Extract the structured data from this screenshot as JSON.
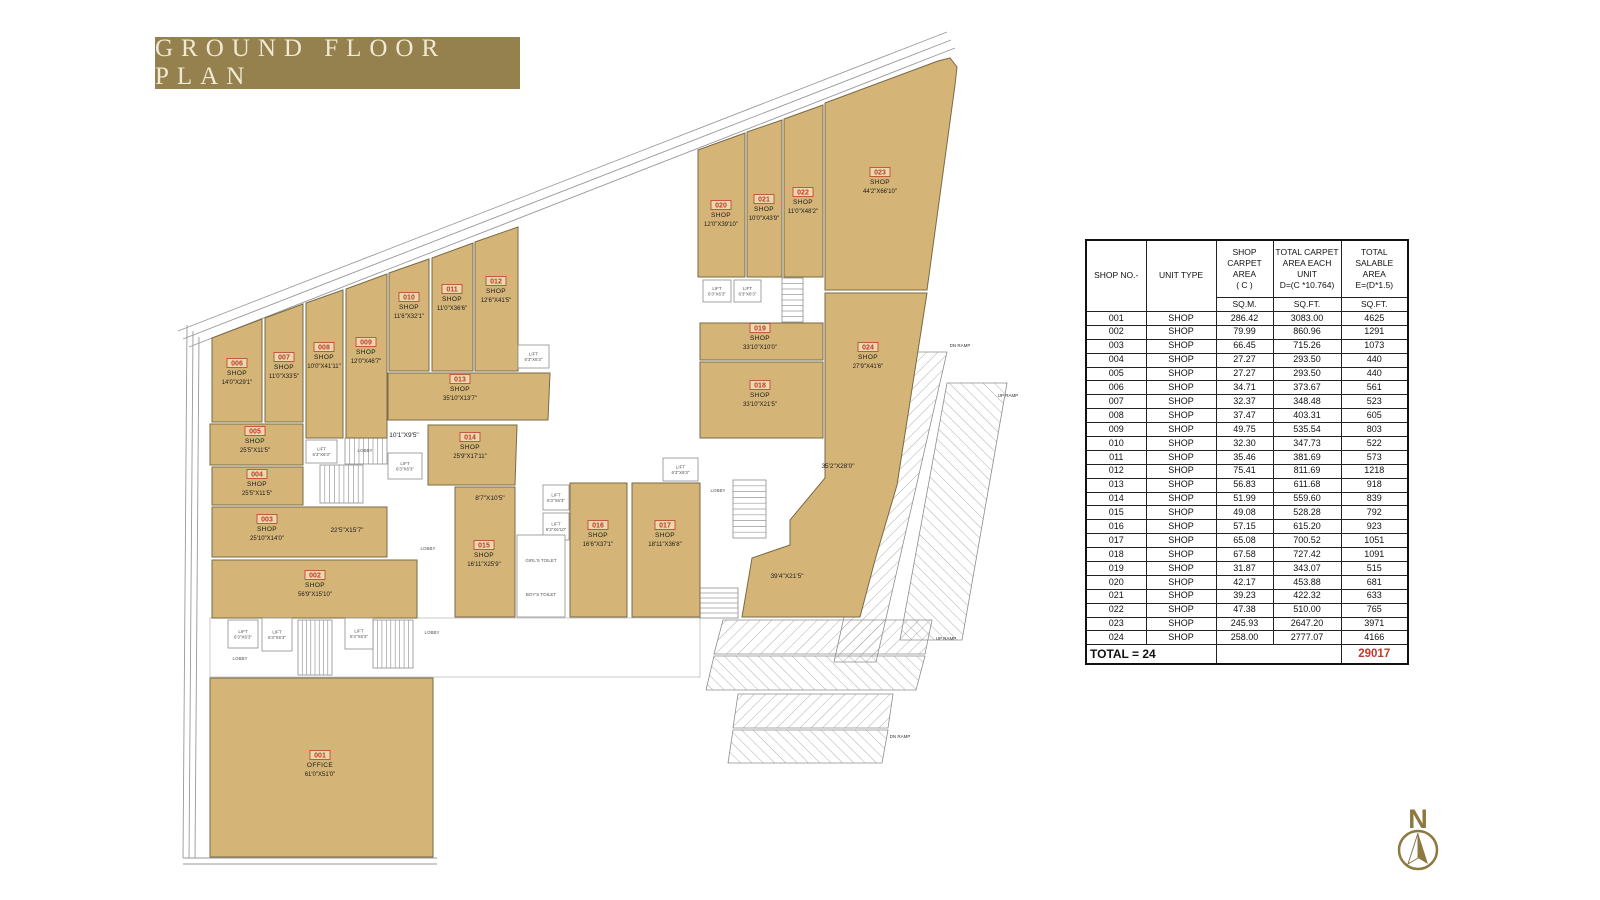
{
  "title": "GROUND FLOOR PLAN",
  "colors": {
    "banner_bg": "#94814e",
    "banner_text": "#f2e9d4",
    "shop_fill": "#d4b577",
    "shop_stroke": "#7a6a45",
    "unit_number_red": "#bf3c28",
    "total_red": "#c0392b",
    "north_gold": "#8d7840",
    "line_gray": "#999999"
  },
  "table": {
    "headers": [
      {
        "lines": [
          "SHOP NO.-"
        ],
        "sub": null
      },
      {
        "lines": [
          "UNIT TYPE"
        ],
        "sub": null
      },
      {
        "lines": [
          "SHOP",
          "CARPET",
          "AREA",
          "( C )"
        ],
        "sub": "SQ.M."
      },
      {
        "lines": [
          "TOTAL CARPET",
          "AREA EACH UNIT",
          "D=(C *10.764)"
        ],
        "sub": "SQ.FT."
      },
      {
        "lines": [
          "TOTAL SALABLE",
          "AREA",
          "E=(D*1.5)"
        ],
        "sub": "SQ.FT."
      }
    ],
    "rows": [
      [
        "001",
        "SHOP",
        "286.42",
        "3083.00",
        "4625"
      ],
      [
        "002",
        "SHOP",
        "79.99",
        "860.96",
        "1291"
      ],
      [
        "003",
        "SHOP",
        "66.45",
        "715.26",
        "1073"
      ],
      [
        "004",
        "SHOP",
        "27.27",
        "293.50",
        "440"
      ],
      [
        "005",
        "SHOP",
        "27.27",
        "293.50",
        "440"
      ],
      [
        "006",
        "SHOP",
        "34.71",
        "373.67",
        "561"
      ],
      [
        "007",
        "SHOP",
        "32.37",
        "348.48",
        "523"
      ],
      [
        "008",
        "SHOP",
        "37.47",
        "403.31",
        "605"
      ],
      [
        "009",
        "SHOP",
        "49.75",
        "535.54",
        "803"
      ],
      [
        "010",
        "SHOP",
        "32.30",
        "347.73",
        "522"
      ],
      [
        "011",
        "SHOP",
        "35.46",
        "381.69",
        "573"
      ],
      [
        "012",
        "SHOP",
        "75.41",
        "811.69",
        "1218"
      ],
      [
        "013",
        "SHOP",
        "56.83",
        "611.68",
        "918"
      ],
      [
        "014",
        "SHOP",
        "51.99",
        "559.60",
        "839"
      ],
      [
        "015",
        "SHOP",
        "49.08",
        "528.28",
        "792"
      ],
      [
        "016",
        "SHOP",
        "57.15",
        "615.20",
        "923"
      ],
      [
        "017",
        "SHOP",
        "65.08",
        "700.52",
        "1051"
      ],
      [
        "018",
        "SHOP",
        "67.58",
        "727.42",
        "1091"
      ],
      [
        "019",
        "SHOP",
        "31.87",
        "343.07",
        "515"
      ],
      [
        "020",
        "SHOP",
        "42.17",
        "453.88",
        "681"
      ],
      [
        "021",
        "SHOP",
        "39.23",
        "422.32",
        "633"
      ],
      [
        "022",
        "SHOP",
        "47.38",
        "510.00",
        "765"
      ],
      [
        "023",
        "SHOP",
        "245.93",
        "2647.20",
        "3971"
      ],
      [
        "024",
        "SHOP",
        "258.00",
        "2777.07",
        "4166"
      ]
    ],
    "total_label": "TOTAL = 24",
    "total_value": "29017"
  },
  "plan": {
    "shops": [
      {
        "no": "001",
        "type": "OFFICE",
        "dim": "61'0\"X51'0\"",
        "poly": [
          [
            210,
            678
          ],
          [
            433,
            678
          ],
          [
            433,
            857
          ],
          [
            210,
            857
          ]
        ],
        "lx": 320,
        "ly": 758
      },
      {
        "no": "002",
        "type": "SHOP",
        "dim": "56'9\"X15'10\"",
        "poly": [
          [
            212,
            560
          ],
          [
            417,
            560
          ],
          [
            417,
            618
          ],
          [
            212,
            618
          ]
        ],
        "lx": 315,
        "ly": 578
      },
      {
        "no": "003",
        "type": "SHOP",
        "dim": "25'10\"X14'0\"",
        "poly": [
          [
            212,
            507
          ],
          [
            387,
            507
          ],
          [
            387,
            557
          ],
          [
            212,
            557
          ]
        ],
        "lx": 267,
        "ly": 522
      },
      {
        "no": "004",
        "type": "SHOP",
        "dim": "25'5\"X11'5\"",
        "poly": [
          [
            212,
            467
          ],
          [
            303,
            467
          ],
          [
            303,
            505
          ],
          [
            212,
            505
          ]
        ],
        "lx": 257,
        "ly": 477
      },
      {
        "no": "005",
        "type": "SHOP",
        "dim": "25'5\"X11'5\"",
        "poly": [
          [
            210,
            424
          ],
          [
            303,
            424
          ],
          [
            303,
            465
          ],
          [
            210,
            465
          ]
        ],
        "lx": 255,
        "ly": 434
      },
      {
        "no": "006",
        "type": "SHOP",
        "dim": "14'0\"X29'1\"",
        "poly": [
          [
            212,
            338
          ],
          [
            262,
            319
          ],
          [
            262,
            422
          ],
          [
            212,
            422
          ]
        ],
        "lx": 237,
        "ly": 366
      },
      {
        "no": "007",
        "type": "SHOP",
        "dim": "11'0\"X33'5\"",
        "poly": [
          [
            265,
            318
          ],
          [
            303,
            304
          ],
          [
            303,
            422
          ],
          [
            265,
            422
          ]
        ],
        "lx": 284,
        "ly": 360
      },
      {
        "no": "008",
        "type": "SHOP",
        "dim": "10'0\"X41'11\"",
        "poly": [
          [
            306,
            303
          ],
          [
            343,
            290
          ],
          [
            343,
            438
          ],
          [
            306,
            438
          ]
        ],
        "lx": 324,
        "ly": 350
      },
      {
        "no": "009",
        "type": "SHOP",
        "dim": "12'0\"X46'7\"",
        "poly": [
          [
            346,
            289
          ],
          [
            387,
            274
          ],
          [
            387,
            438
          ],
          [
            346,
            438
          ]
        ],
        "lx": 366,
        "ly": 345
      },
      {
        "no": "010",
        "type": "SHOP",
        "dim": "11'6\"X32'1\"",
        "poly": [
          [
            389,
            273
          ],
          [
            429,
            259
          ],
          [
            429,
            371
          ],
          [
            389,
            371
          ]
        ],
        "lx": 409,
        "ly": 300
      },
      {
        "no": "011",
        "type": "SHOP",
        "dim": "11'0\"X36'6\"",
        "poly": [
          [
            432,
            258
          ],
          [
            473,
            243
          ],
          [
            473,
            371
          ],
          [
            432,
            371
          ]
        ],
        "lx": 452,
        "ly": 292
      },
      {
        "no": "012",
        "type": "SHOP",
        "dim": "12'6\"X41'5\"",
        "poly": [
          [
            475,
            242
          ],
          [
            518,
            227
          ],
          [
            518,
            371
          ],
          [
            475,
            371
          ]
        ],
        "lx": 496,
        "ly": 284
      },
      {
        "no": "013",
        "type": "SHOP",
        "dim": "35'10\"X13'7\"",
        "poly": [
          [
            388,
            373
          ],
          [
            550,
            373
          ],
          [
            548,
            420
          ],
          [
            388,
            420
          ]
        ],
        "lx": 460,
        "ly": 382
      },
      {
        "no": "014",
        "type": "SHOP",
        "dim": "25'9\"X17'11\"",
        "poly": [
          [
            428,
            425
          ],
          [
            517,
            425
          ],
          [
            515,
            485
          ],
          [
            428,
            485
          ]
        ],
        "lx": 470,
        "ly": 440
      },
      {
        "no": "015",
        "type": "SHOP",
        "dim": "16'11\"X25'9\"",
        "poly": [
          [
            455,
            487
          ],
          [
            515,
            487
          ],
          [
            515,
            617
          ],
          [
            455,
            617
          ]
        ],
        "lx": 484,
        "ly": 548
      },
      {
        "no": "016",
        "type": "SHOP",
        "dim": "16'6\"X37'1\"",
        "poly": [
          [
            570,
            483
          ],
          [
            627,
            483
          ],
          [
            627,
            617
          ],
          [
            570,
            617
          ]
        ],
        "lx": 598,
        "ly": 528
      },
      {
        "no": "017",
        "type": "SHOP",
        "dim": "18'11\"X36'8\"",
        "poly": [
          [
            632,
            483
          ],
          [
            700,
            483
          ],
          [
            700,
            617
          ],
          [
            632,
            617
          ]
        ],
        "lx": 665,
        "ly": 528
      },
      {
        "no": "018",
        "type": "SHOP",
        "dim": "33'10\"X21'5\"",
        "poly": [
          [
            700,
            362
          ],
          [
            823,
            362
          ],
          [
            823,
            438
          ],
          [
            700,
            438
          ]
        ],
        "lx": 760,
        "ly": 388
      },
      {
        "no": "019",
        "type": "SHOP",
        "dim": "33'10\"X10'0\"",
        "poly": [
          [
            700,
            323
          ],
          [
            823,
            323
          ],
          [
            823,
            360
          ],
          [
            700,
            360
          ]
        ],
        "lx": 760,
        "ly": 331
      },
      {
        "no": "020",
        "type": "SHOP",
        "dim": "12'0\"X39'10\"",
        "poly": [
          [
            698,
            150
          ],
          [
            745,
            133
          ],
          [
            745,
            277
          ],
          [
            698,
            277
          ]
        ],
        "lx": 721,
        "ly": 208
      },
      {
        "no": "021",
        "type": "SHOP",
        "dim": "10'0\"X43'9\"",
        "poly": [
          [
            747,
            132
          ],
          [
            782,
            120
          ],
          [
            782,
            277
          ],
          [
            747,
            277
          ]
        ],
        "lx": 764,
        "ly": 202
      },
      {
        "no": "022",
        "type": "SHOP",
        "dim": "11'0\"X48'2\"",
        "poly": [
          [
            784,
            119
          ],
          [
            823,
            105
          ],
          [
            823,
            277
          ],
          [
            784,
            277
          ]
        ],
        "lx": 803,
        "ly": 195
      },
      {
        "no": "023",
        "type": "SHOP",
        "dim": "44'2\"X66'10\"",
        "poly": [
          [
            825,
            103
          ],
          [
            938,
            61
          ],
          [
            950,
            58
          ],
          [
            957,
            67
          ],
          [
            955,
            85
          ],
          [
            927,
            290
          ],
          [
            825,
            290
          ]
        ],
        "lx": 880,
        "ly": 175
      },
      {
        "no": "024",
        "type": "SHOP",
        "dim": "27'9\"X41'6\"",
        "poly": [
          [
            825,
            293
          ],
          [
            927,
            293
          ],
          [
            897,
            485
          ],
          [
            875,
            560
          ],
          [
            860,
            617
          ],
          [
            742,
            617
          ],
          [
            752,
            558
          ],
          [
            790,
            545
          ],
          [
            790,
            520
          ],
          [
            825,
            478
          ]
        ],
        "lx": 868,
        "ly": 350
      }
    ],
    "dims": [
      {
        "text": "22'5\"X15'7\"",
        "x": 347,
        "y": 532
      },
      {
        "text": "10'1\"X9'5\"",
        "x": 404,
        "y": 437
      },
      {
        "text": "8'7\"X10'5\"",
        "x": 490,
        "y": 500
      },
      {
        "text": "35'2\"X28'0\"",
        "x": 838,
        "y": 468
      },
      {
        "text": "39'4\"X21'5\"",
        "x": 787,
        "y": 578
      }
    ],
    "rooms": [
      {
        "x": 518,
        "y": 345,
        "w": 31,
        "h": 23,
        "label": [
          "LIFT",
          "6'3\"X6'3\""
        ]
      },
      {
        "x": 306,
        "y": 440,
        "w": 31,
        "h": 23,
        "label": [
          "LIFT",
          "6'3\"X6'3\""
        ]
      },
      {
        "x": 388,
        "y": 453,
        "w": 34,
        "h": 26,
        "label": [
          "LIFT",
          "6'3\"X6'3\""
        ]
      },
      {
        "x": 663,
        "y": 458,
        "w": 35,
        "h": 23,
        "label": [
          "LIFT",
          "6'3\"X6'3\""
        ]
      },
      {
        "x": 703,
        "y": 280,
        "w": 28,
        "h": 22,
        "label": [
          "LIFT",
          "6'3\"X6'3\""
        ]
      },
      {
        "x": 734,
        "y": 280,
        "w": 27,
        "h": 22,
        "label": [
          "LIFT",
          "6'3\"X6'3\""
        ]
      },
      {
        "x": 543,
        "y": 485,
        "w": 26,
        "h": 25,
        "label": [
          "LIFT",
          "6'3\"X6'3\""
        ]
      },
      {
        "x": 543,
        "y": 513,
        "w": 26,
        "h": 27,
        "label": [
          "LIFT",
          "6'3\"X6'10\""
        ]
      },
      {
        "x": 228,
        "y": 620,
        "w": 30,
        "h": 28,
        "label": [
          "LIFT",
          "6'3\"X6'3\""
        ]
      },
      {
        "x": 262,
        "y": 618,
        "w": 30,
        "h": 33,
        "label": [
          "LIFT",
          "6'3\"X6'3\""
        ]
      },
      {
        "x": 345,
        "y": 618,
        "w": 28,
        "h": 31,
        "label": [
          "LIFT",
          "6'3\"X6'3\""
        ]
      },
      {
        "x": 517,
        "y": 535,
        "w": 48,
        "h": 82,
        "label": []
      }
    ],
    "texts": [
      {
        "text": "LOBBY",
        "x": 365,
        "y": 452
      },
      {
        "text": "LOBBY",
        "x": 428,
        "y": 550
      },
      {
        "text": "LOBBY",
        "x": 718,
        "y": 492
      },
      {
        "text": "LOBBY",
        "x": 240,
        "y": 660
      },
      {
        "text": "LOBBY",
        "x": 432,
        "y": 634
      },
      {
        "text": "GIRL'S TOILET",
        "x": 541,
        "y": 562
      },
      {
        "text": "BOY'S TOILET",
        "x": 541,
        "y": 596
      }
    ],
    "ramp_labels": [
      {
        "text": "DN RAMP",
        "x": 960,
        "y": 347
      },
      {
        "text": "UP RAMP",
        "x": 1008,
        "y": 397
      },
      {
        "text": "UP RAMP",
        "x": 946,
        "y": 640
      },
      {
        "text": "DN RAMP",
        "x": 900,
        "y": 738
      }
    ]
  },
  "north": {
    "label": "N"
  }
}
